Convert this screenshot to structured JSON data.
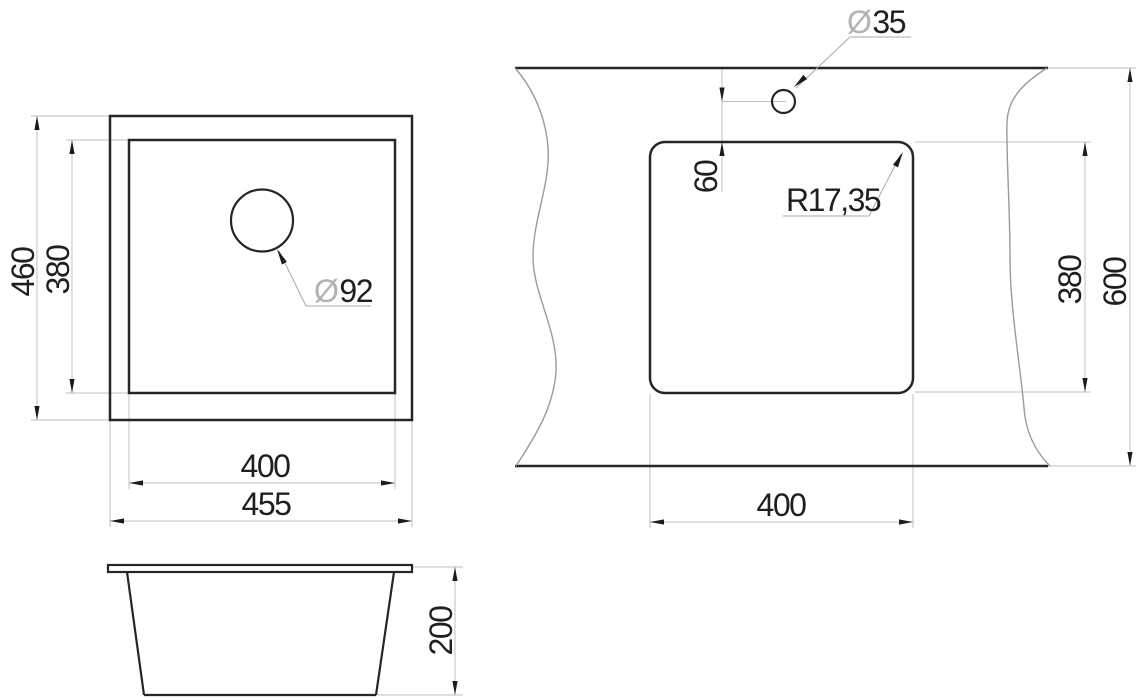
{
  "drawing": {
    "type": "sink-installation-technical-drawing",
    "top_view": {
      "height_outer": "460",
      "height_inner": "380",
      "width_inner": "400",
      "width_outer": "455",
      "drain_symbol": "Ø",
      "drain_value": "92"
    },
    "side_view": {
      "depth": "200"
    },
    "cutout_view": {
      "hole_symbol": "Ø",
      "hole_value": "35",
      "hole_offset": "60",
      "corner_radius": "R17,35",
      "cutout_height": "380",
      "panel_height": "600",
      "cutout_width": "400"
    },
    "colors": {
      "background": "#ffffff",
      "object_line": "#262626",
      "dimension_line": "#bfbfbf",
      "leader_line": "#a9a9a9",
      "break_line": "#9a9a9a",
      "diameter_symbol": "#b3b3b3",
      "text": "#1f1f1f"
    }
  }
}
